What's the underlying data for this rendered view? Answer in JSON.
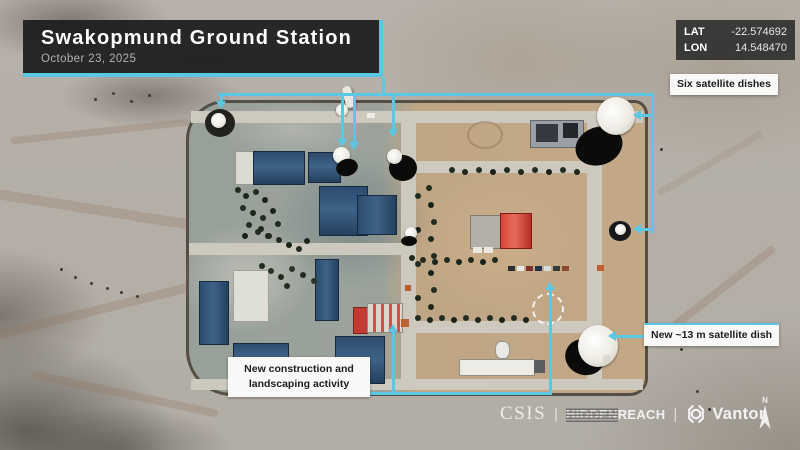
{
  "colors": {
    "accent": "#5cc7e3",
    "panel_bg": "#1e1e1e",
    "label_bg": "#f8f8f6",
    "label_text": "#1c1c1c"
  },
  "header": {
    "title": "Swakopmund Ground Station",
    "date": "October 23, 2025"
  },
  "coords": {
    "lat_label": "LAT",
    "lat_value": "-22.574692",
    "lon_label": "LON",
    "lon_value": "14.548470"
  },
  "callouts": {
    "six_dishes": "Six satellite dishes",
    "new_dish": "New ~13 m satellite dish",
    "construction1": "New construction and",
    "construction2": "landscaping activity"
  },
  "footer": {
    "csis": "CSIS",
    "separator": "|",
    "hidden": "HIDDEN",
    "reach": "REACH",
    "vantor": "Vantor",
    "north": "N"
  },
  "icons": {
    "vantor_logo": "aperture-ring-in-brackets",
    "north_arrow": "map-north-arrow"
  }
}
